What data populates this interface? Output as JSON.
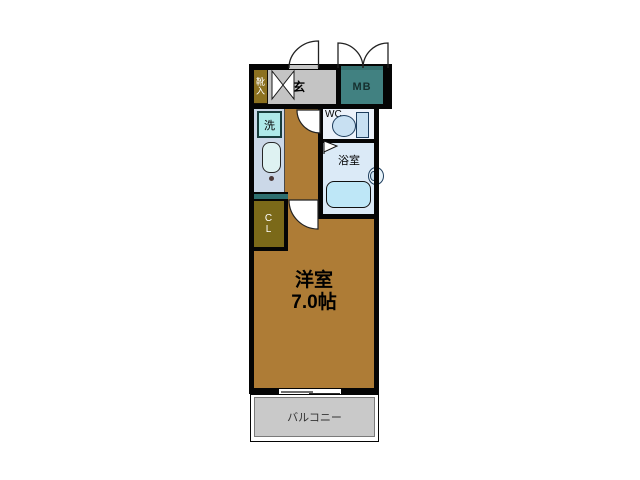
{
  "floorplan": {
    "rooms": {
      "shoe_cabinet": {
        "label": "靴入"
      },
      "entrance": {
        "label": "玄"
      },
      "meter_box": {
        "label": "MB"
      },
      "laundry": {
        "label": "洗"
      },
      "toilet": {
        "label": "WC"
      },
      "bathroom": {
        "label": "浴室"
      },
      "closet": {
        "line1": "C",
        "line2": "L"
      },
      "main_room": {
        "name": "洋室",
        "size": "7.0帖"
      },
      "balcony": {
        "label": "バルコニー"
      }
    },
    "colors": {
      "room_floor": "#AE7C36",
      "entrance_floor": "#C4C4C4",
      "meter_box": "#418181",
      "shoe_cabinet": "#8C7120",
      "closet": "#7B6919",
      "counter_teal": "#2E6F6F",
      "kitchen_counter": "#CBD8E8",
      "laundry": "#AEE9E9",
      "wc_floor": "#ECF2FA",
      "bath_floor": "#DBEAF7",
      "bathtub": "#BEE7F7",
      "balcony": "#C9C9C9",
      "wall": "#050505"
    }
  }
}
